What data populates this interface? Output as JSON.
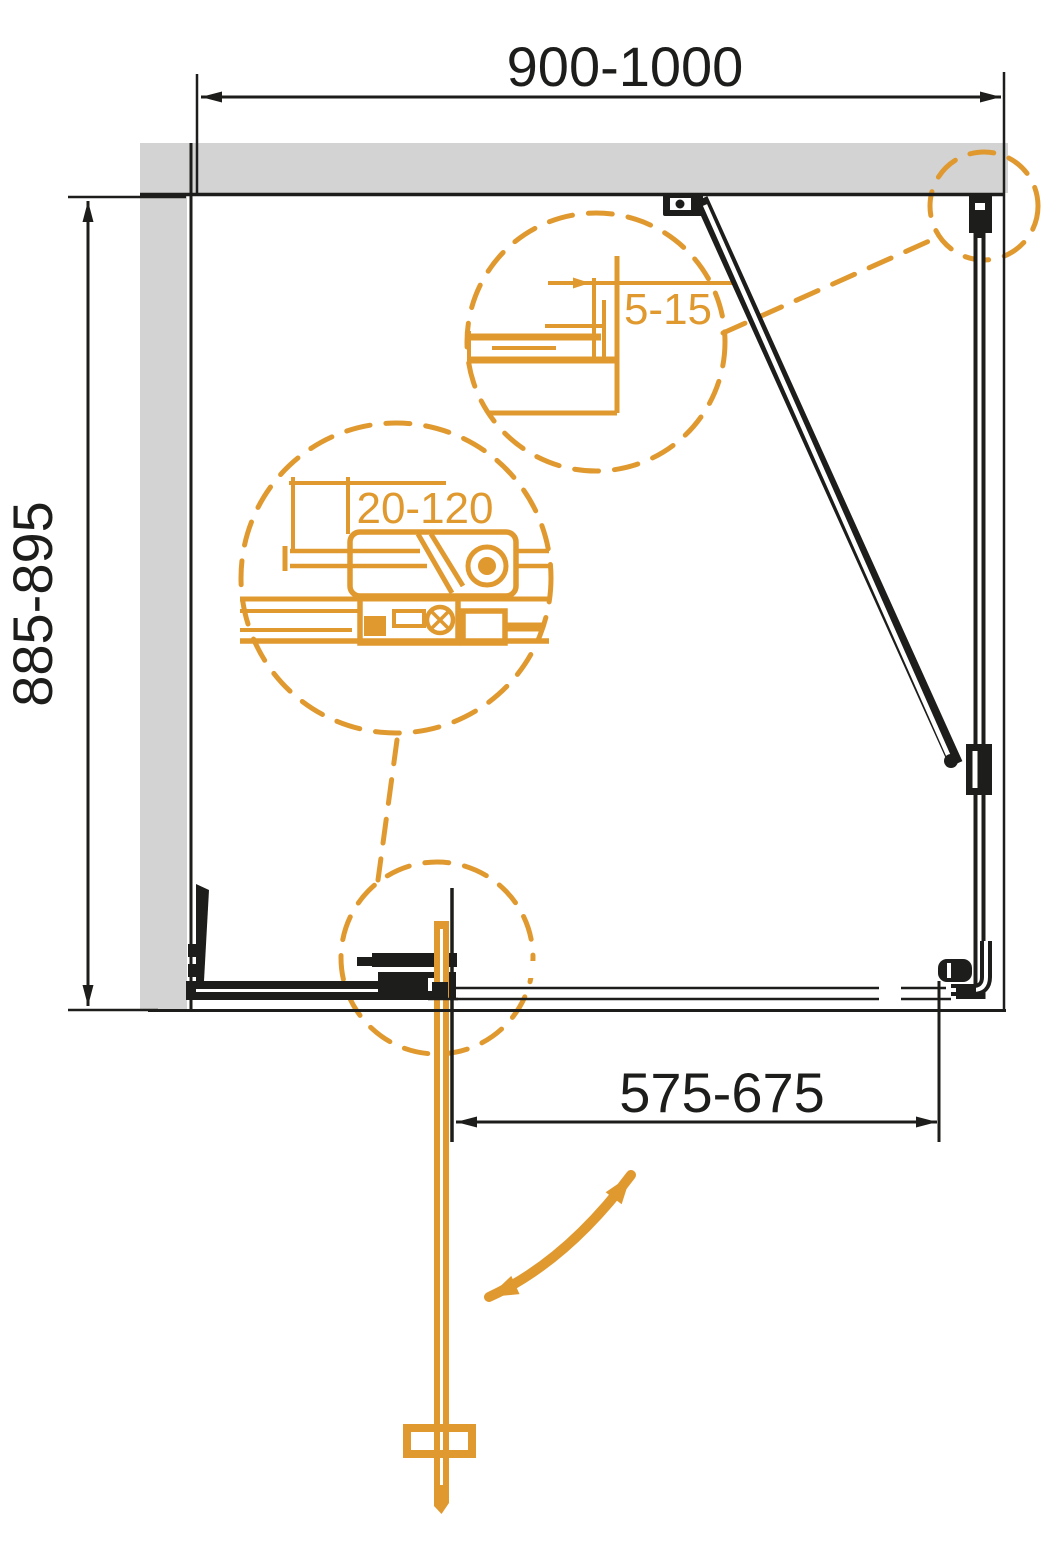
{
  "drawing": {
    "type": "shower-enclosure-installation-plan-view",
    "dimensions": {
      "width_range": "900-1000",
      "depth_range": "885-895",
      "door_opening_range": "575-675",
      "wall_profile_adjustment": "5-15",
      "extension_profile_adjustment": "20-120"
    }
  },
  "colors": {
    "accent": "#E0992F",
    "line": "#1D1D1B",
    "wall": "#D3D3D3",
    "bg": "#FFFFFF"
  }
}
